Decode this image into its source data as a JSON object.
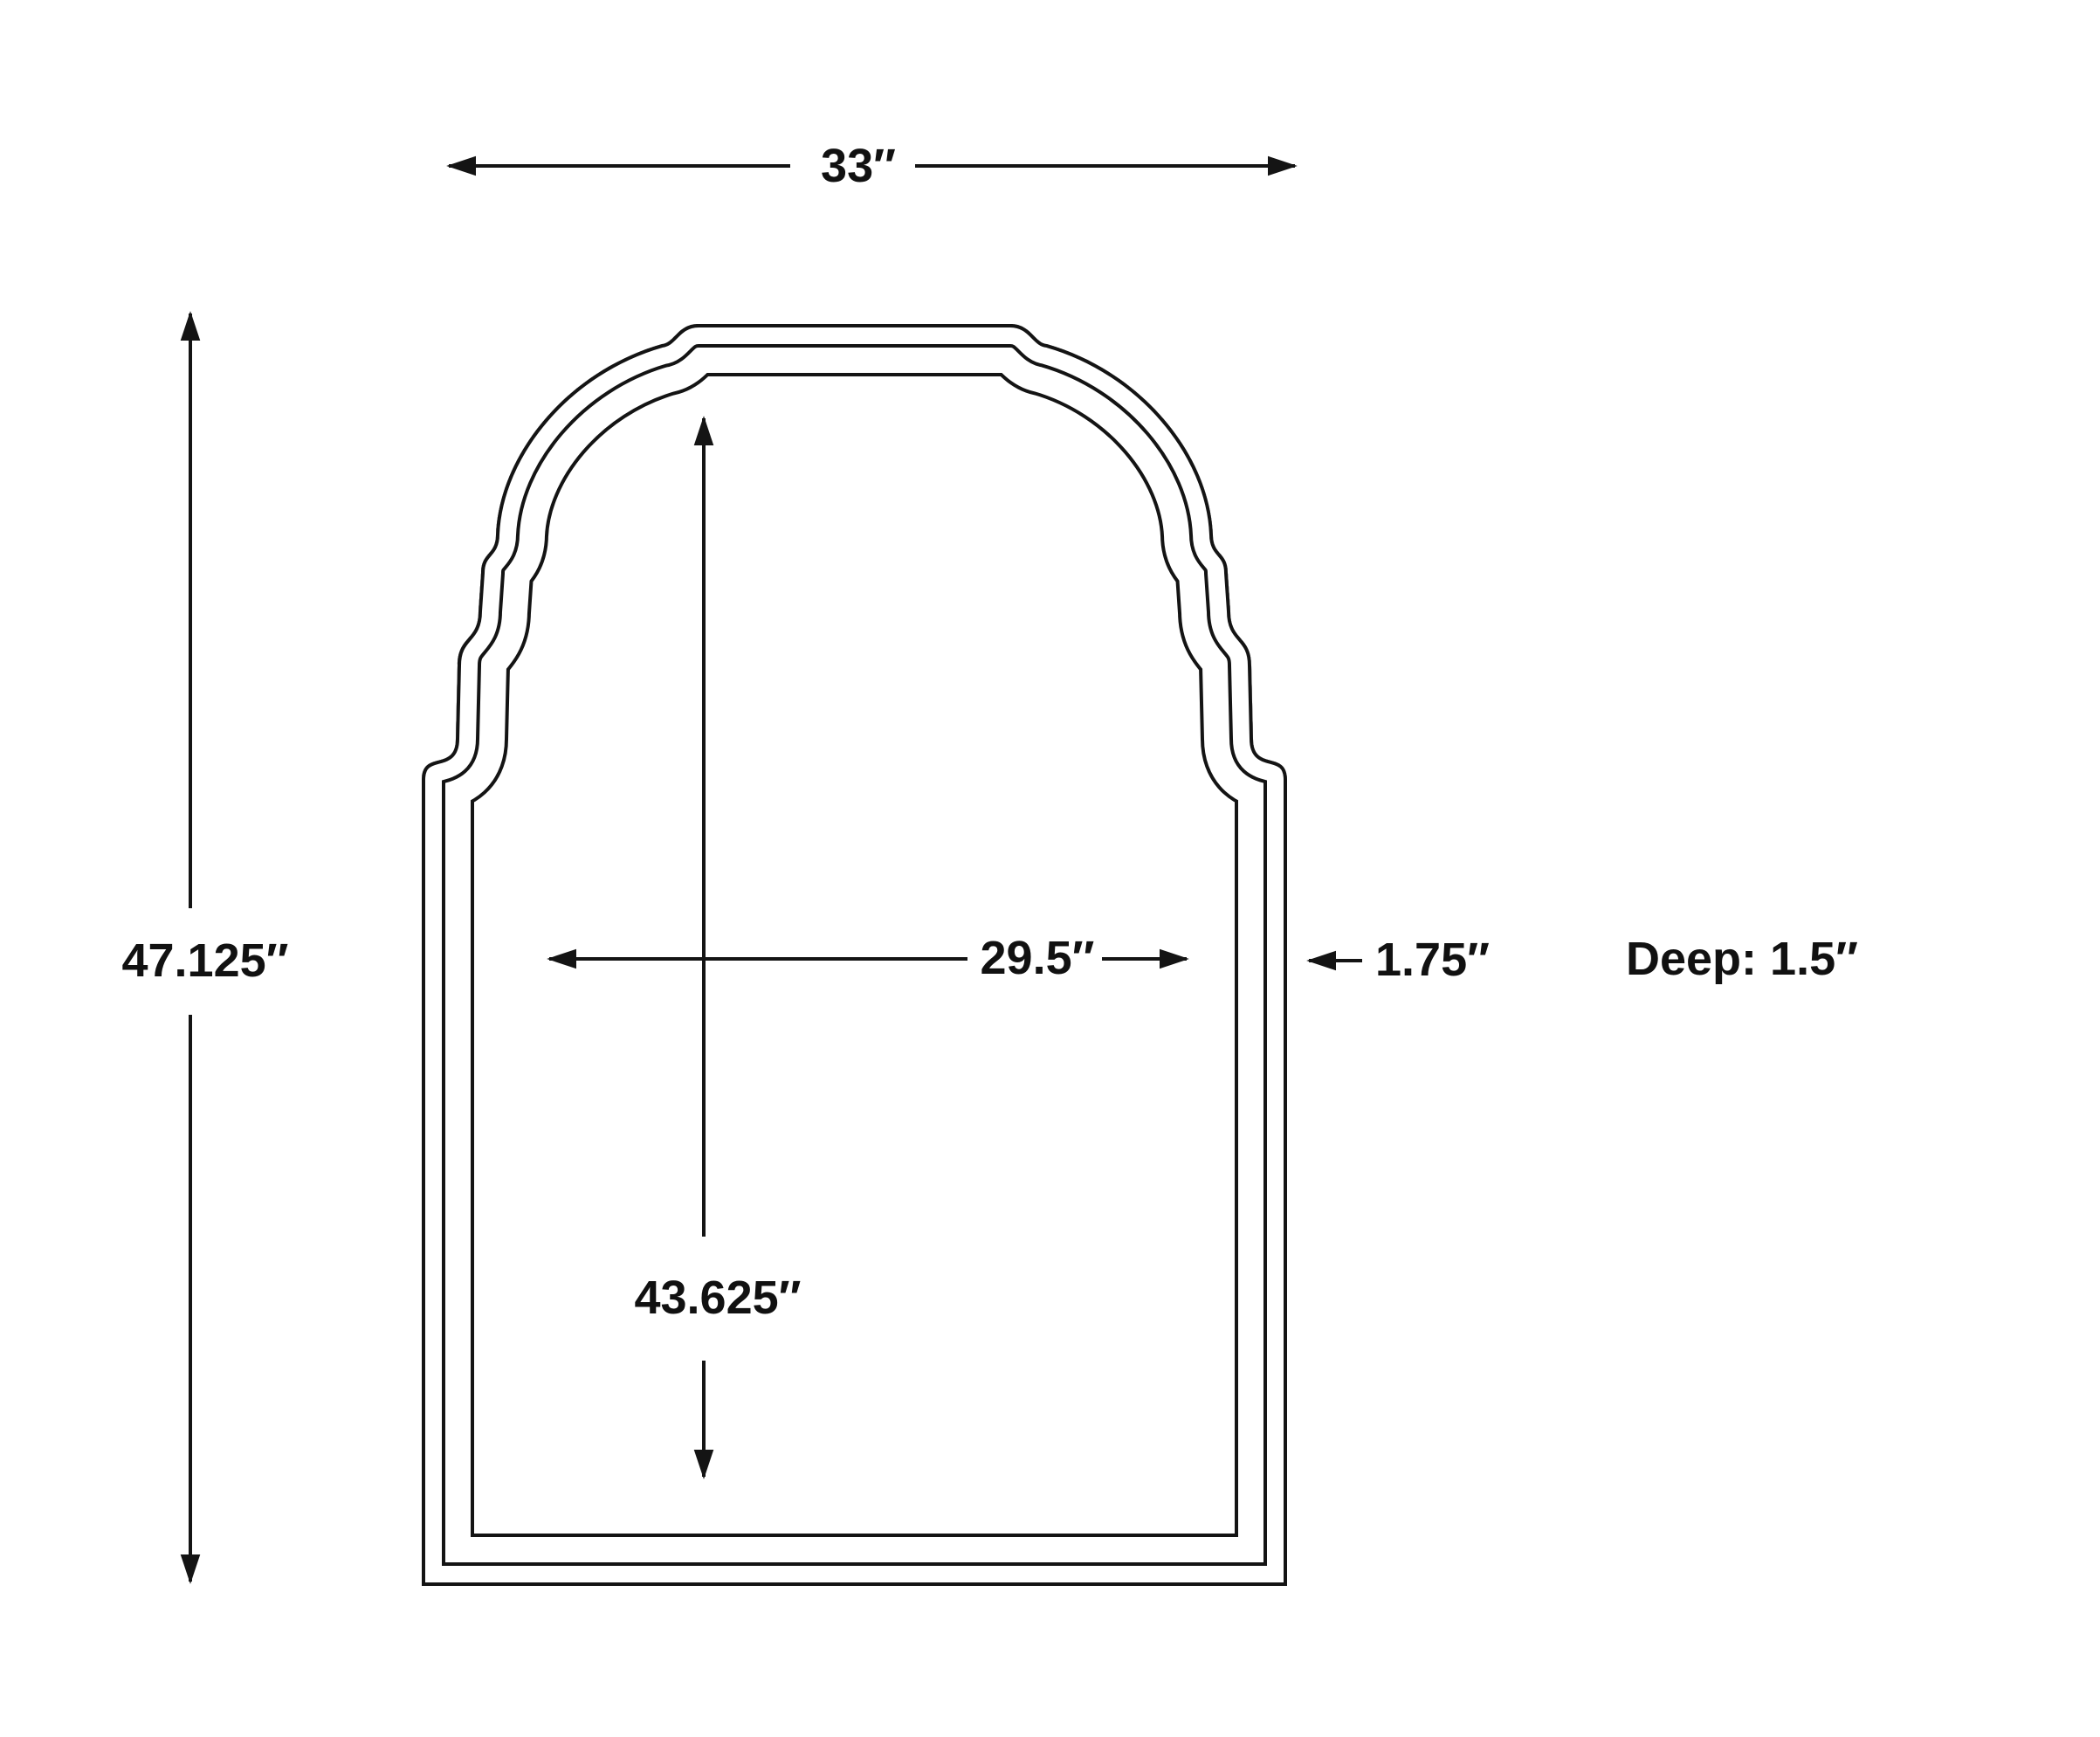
{
  "page": {
    "background": "#ffffff",
    "line_color": "#141414",
    "text_color": "#111111"
  },
  "diagram": {
    "labels": {
      "overall_width": "33″",
      "overall_height": "47.125″",
      "inner_width": "29.5″",
      "frame_thickness": "1.75″",
      "inner_height": "43.625″",
      "depth": "Deep: 1.5″"
    },
    "dimensions": {
      "overall_width_in": 33,
      "overall_height_in": 47.125,
      "inner_width_in": 29.5,
      "frame_thickness_in": 1.75,
      "inner_height_in": 43.625,
      "depth_in": 1.5
    }
  }
}
